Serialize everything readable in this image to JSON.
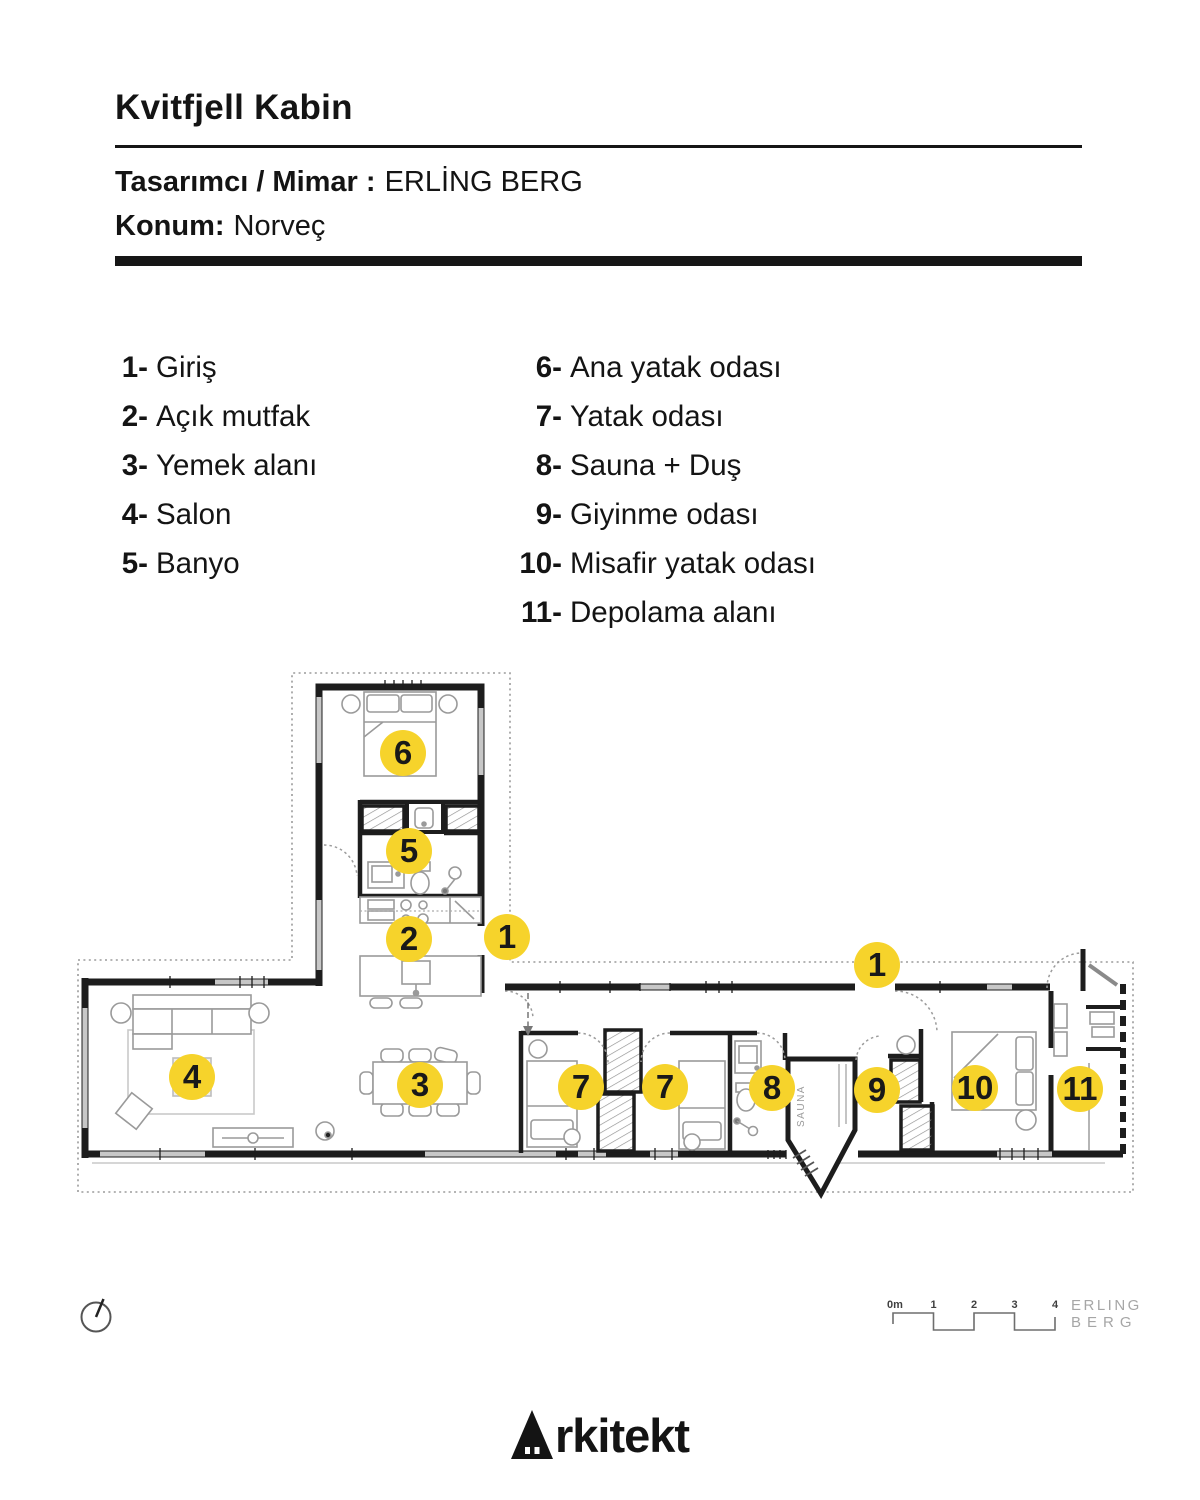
{
  "header": {
    "title": "Kvitfjell Kabin",
    "designer_label": "Tasarımcı / Mimar :",
    "designer_value": "ERLİNG BERG",
    "location_label": "Konum:",
    "location_value": "Norveç"
  },
  "legend": {
    "left": [
      {
        "num": "1-",
        "label": "Giriş"
      },
      {
        "num": "2-",
        "label": "Açık mutfak"
      },
      {
        "num": "3-",
        "label": "Yemek alanı"
      },
      {
        "num": "4-",
        "label": "Salon"
      },
      {
        "num": "5-",
        "label": "Banyo"
      }
    ],
    "right": [
      {
        "num": "6-",
        "label": "Ana yatak odası"
      },
      {
        "num": "7-",
        "label": "Yatak odası"
      },
      {
        "num": "8-",
        "label": "Sauna + Duş"
      },
      {
        "num": "9-",
        "label": "Giyinme odası"
      },
      {
        "num": "10-",
        "label": "Misafir yatak odası"
      },
      {
        "num": "11-",
        "label": "Depolama alanı"
      }
    ]
  },
  "plan": {
    "sauna_label": "SAUNA",
    "badge_color": "#F6D32B",
    "badges": [
      {
        "n": "6",
        "x": 403,
        "y": 753
      },
      {
        "n": "5",
        "x": 409,
        "y": 851
      },
      {
        "n": "2",
        "x": 409,
        "y": 939
      },
      {
        "n": "1",
        "x": 507,
        "y": 937
      },
      {
        "n": "1",
        "x": 877,
        "y": 965
      },
      {
        "n": "4",
        "x": 192,
        "y": 1077
      },
      {
        "n": "3",
        "x": 420,
        "y": 1085
      },
      {
        "n": "7",
        "x": 581,
        "y": 1087
      },
      {
        "n": "7",
        "x": 665,
        "y": 1087
      },
      {
        "n": "8",
        "x": 772,
        "y": 1088
      },
      {
        "n": "9",
        "x": 877,
        "y": 1090
      },
      {
        "n": "10",
        "x": 975,
        "y": 1088
      },
      {
        "n": "11",
        "x": 1080,
        "y": 1089
      }
    ]
  },
  "scalebar": {
    "labels": [
      "0m",
      "1",
      "2",
      "3",
      "4"
    ]
  },
  "branding": {
    "architect_line1": "ERLING",
    "architect_line2": "BERG",
    "logo_full": "Arkitekt",
    "logo_text_rest": "rkitekt"
  },
  "icons": {
    "compass": "compass-icon",
    "logo_a": "house-a-icon"
  },
  "colors": {
    "badge_yellow": "#F6D32B",
    "wall_black": "#1d1d1d",
    "line_gray": "#9a9a9a"
  }
}
